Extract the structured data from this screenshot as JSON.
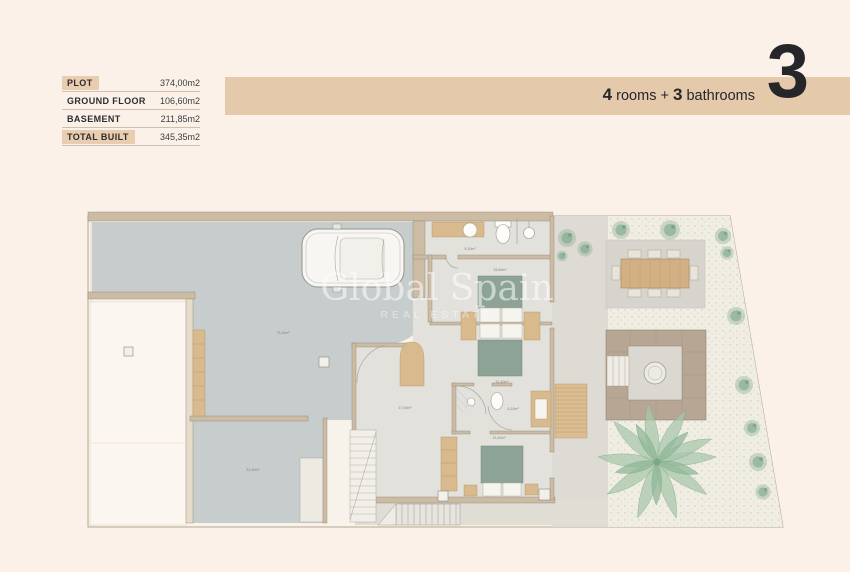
{
  "page": {
    "background": "#fcf1e9"
  },
  "summary": {
    "rows": [
      {
        "label": "PLOT",
        "value": "374,00m2"
      },
      {
        "label": "GROUND FLOOR",
        "value": "106,60m2"
      },
      {
        "label": "BASEMENT",
        "value": "211,85m2"
      },
      {
        "label": "TOTAL BUILT",
        "value": "345,35m2"
      }
    ]
  },
  "header": {
    "rooms_number": "4",
    "rooms_word": "rooms",
    "plus": "+",
    "bathrooms_number": "3",
    "bathrooms_word": "bathrooms",
    "unit_number": "3"
  },
  "watermark": {
    "title": "Global Spain",
    "subtitle": "REAL ESTATE"
  },
  "floor_plan": {
    "area_labels": [
      {
        "room": "basement-garage",
        "text": "73,40m²"
      },
      {
        "room": "basement-room",
        "text": "31,40m²"
      },
      {
        "room": "bathroom-top",
        "text": "9,10m²"
      },
      {
        "room": "bedroom-1",
        "text": "15,60m²"
      },
      {
        "room": "hall",
        "text": "17,00m²"
      },
      {
        "room": "bathroom-2",
        "text": "5,10m²"
      },
      {
        "room": "bedroom-2",
        "text": "12,40m²"
      },
      {
        "room": "bedroom-3",
        "text": "13,40m²"
      }
    ]
  },
  "colors": {
    "band": "#e4c9ab",
    "highlight": "#e8cdb0",
    "driveway_gray": "#c7cccd",
    "bed_green": "#8da396",
    "wood": "#d9ba8e",
    "gravel": "#f0ede3"
  }
}
